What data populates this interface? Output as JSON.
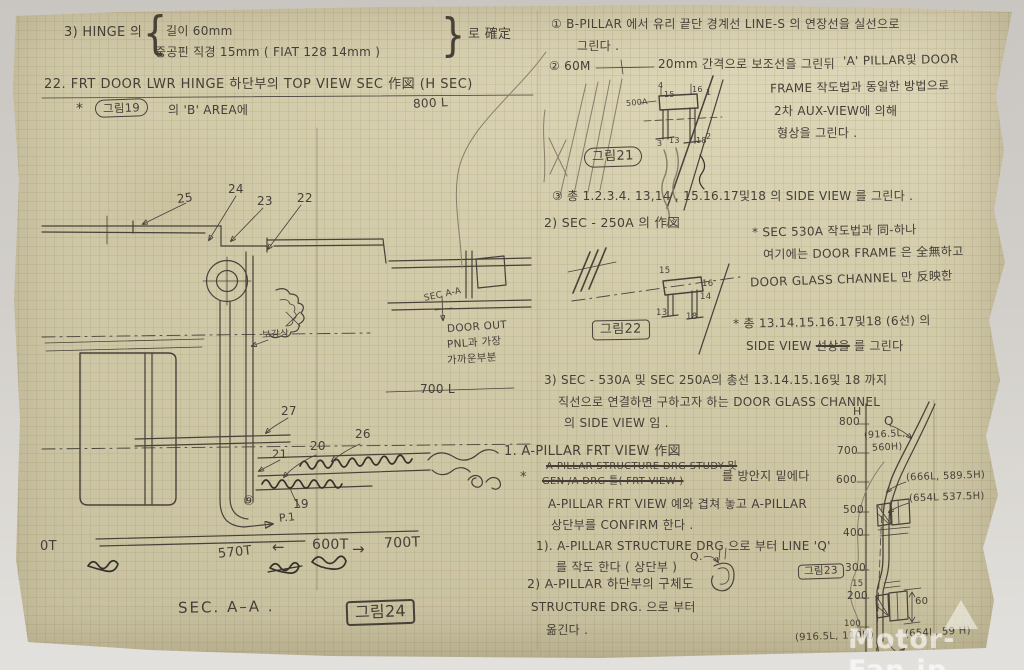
{
  "colors": {
    "paper": "#d3ccab",
    "ink": "#47413a",
    "pencil": "#877d6a",
    "backdrop": "#d2cfca"
  },
  "paper": {
    "watermark": "Motor-Fan.jp"
  },
  "notes": {
    "n3": {
      "head": "3) HINGE 의",
      "brace_open": "{",
      "line1": "길이 60mm",
      "line2": "중공핀 직경 15mm ( FIAT 128  14mm )",
      "brace_close": "}",
      "tail": "로 確定"
    },
    "n22": {
      "title": "22.  FRT DOOR LWR HINGE 하단부의 TOP VIEW  SEC 作図 (H SEC)",
      "star": "*",
      "figref": "그림19",
      "area": "의 'B' AREA에",
      "h800": "800 L"
    }
  },
  "diagram_left": {
    "parts": [
      "25",
      "24",
      "23",
      "22",
      "27",
      "21",
      "20",
      "26",
      "19"
    ],
    "circled": "⑨",
    "p_ref": "P.1",
    "section_note": "보강상",
    "sec_aa_small": "SEC A-A",
    "door_note1": "DOOR OUT",
    "door_note2": "PNL과 가장",
    "door_note3": "가까운부분",
    "h700": "700 L",
    "scale_0": "0T",
    "scale_570": "570T",
    "arrow_left": "←",
    "scale_600": "600T",
    "arrow_right": "→",
    "scale_700": "700T",
    "caption": "SEC. A–A .",
    "figref": "그림24"
  },
  "notes_right": {
    "c1a": "① B-PILLAR 에서 유리 끝단 경계선 LINE-S 의 연장선을 실선으로",
    "c1b": "그린다 .",
    "c2a": "② 60M",
    "c2b": "20mm 간격으로 보조선을 그린뒤",
    "c2c": "'A' PILLAR및 DOOR",
    "c2d": "FRAME 작도법과 동일한 방법으로",
    "c2e": "2차 AUX-VIEW에 의해",
    "c2f": "형상을 그린다 .",
    "fig21": "그림21",
    "c3": "③ 총 1.2.3.4. 13,14 , 15.16.17및18 의 SIDE VIEW 를 그린다 .",
    "s2_head": "2) SEC - 250A 의 作図",
    "s2n1": "* SEC 530A 작도법과 同-하나",
    "s2n2": "여기에는 DOOR FRAME 은 全無하고",
    "s2n3": "DOOR GLASS CHANNEL 만 反映한",
    "fig22": "그림22",
    "s2n4": "* 총 13.14.15.16.17및18 (6선) 의",
    "s2n5a": "SIDE VIEW ",
    "s2n5strike": "선상을",
    "s2n5b": " 를 그린다",
    "s3a": "3) SEC - 530A 및 SEC 250A의 총선 13.14.15.16및 18 까지",
    "s3b": "직선으로 연결하면 구하고자 하는 DOOR GLASS CHANNEL",
    "s3c": "의 SIDE VIEW 임 .",
    "a1_head": "1.  A-PILLAR FRT VIEW 作図",
    "a1_star": "*",
    "a1_strike1": "A-PILLAR STRUCTURE DRG STUDY 및",
    "a1_strike2": "GEN /A DRG 틀( FRT VIEW )",
    "a1_rest": "를 방안지 밑에다",
    "a1_l2": "A-PILLAR FRT VIEW 예와 겹쳐 놓고 A-PILLAR",
    "a1_l3": "상단부를 CONFIRM 한다 .",
    "a1_1a": "1). A-PILLAR STRUCTURE DRG 으로 부터 LINE 'Q'",
    "a1_1b": "를 작도 한다 ( 상단부 )",
    "q_label": "Q.",
    "a1_2a": "2) A-PILLAR 하단부의 구체도",
    "a1_2b": "STRUCTURE DRG. 으로 부터",
    "a1_2c": "옮긴다 .",
    "fig23": "그림23"
  },
  "sketch530": {
    "n500A": "500A",
    "n4": "4",
    "n15": "15",
    "n16": "16",
    "n1": "1",
    "n3": "3",
    "n13": "13",
    "n18": "18",
    "n2": "2"
  },
  "sketch250": {
    "n15": "15",
    "n16": "16",
    "n14": "14",
    "n13": "13",
    "n18": "18"
  },
  "axis": {
    "H": "H",
    "t800": "800",
    "t700": "700",
    "t600": "600",
    "t500": "500",
    "t400": "400",
    "t300": "300",
    "t200": "200",
    "t100": "100",
    "q": "Q",
    "p1": "(916.5L,",
    "p1b": "560H)",
    "p2": "(666L, 589.5H)",
    "p3": "(654L 537.5H)",
    "d15": "15",
    "d60": "60",
    "p4": "(916.5L, 110H)",
    "p5": "(654L, 59 H)"
  }
}
